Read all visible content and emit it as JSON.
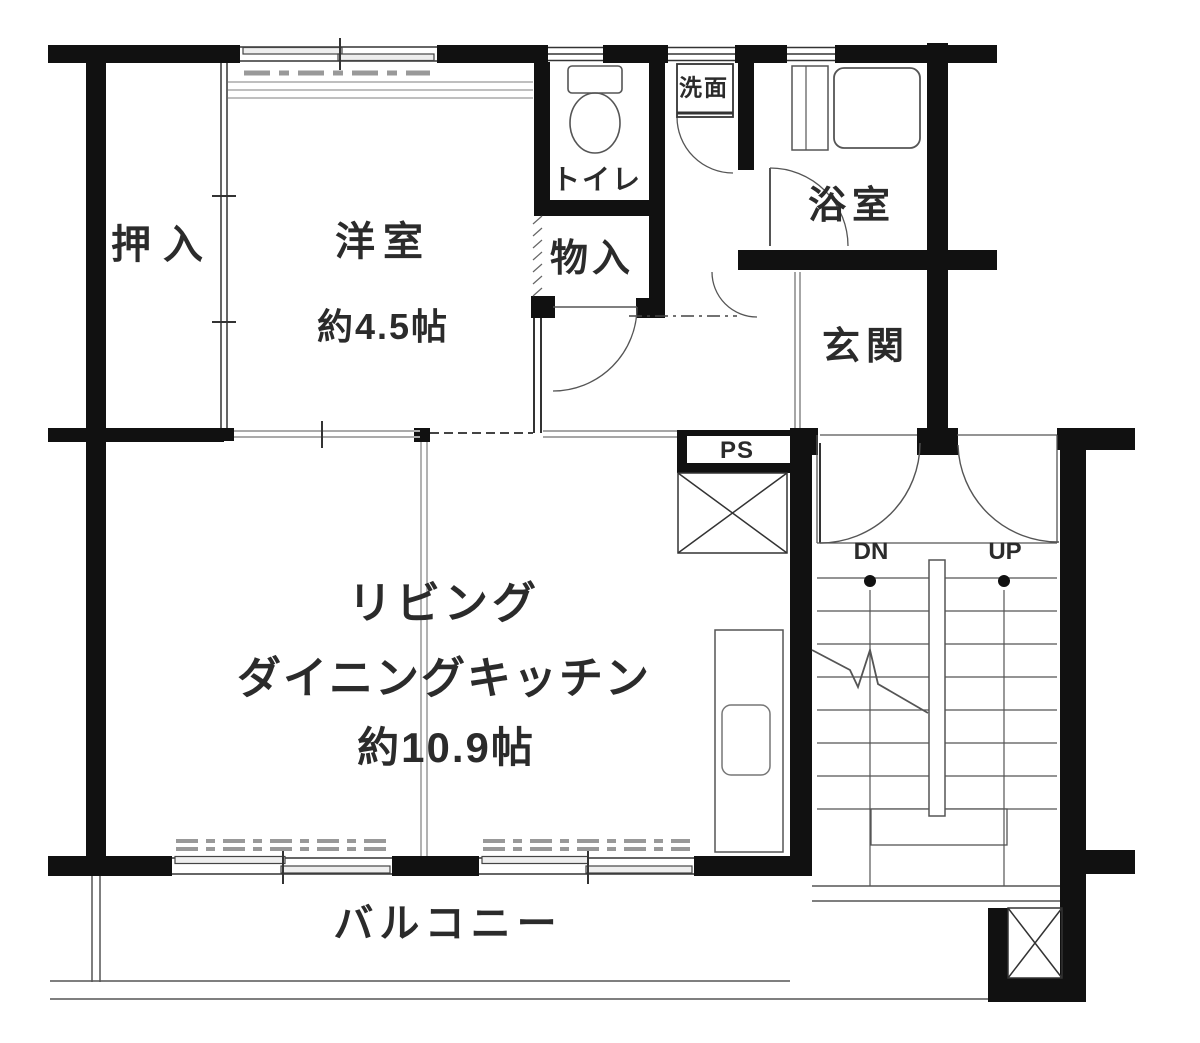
{
  "plan": {
    "rooms": {
      "closet": "押入",
      "western_room": "洋室",
      "western_room_size": "約4.5帖",
      "toilet": "トイレ",
      "washstand": "洗面",
      "storage": "物入",
      "bathroom": "浴室",
      "entrance": "玄関",
      "living_line1": "リビング",
      "living_line2": "ダイニングキッチン",
      "living_size": "約10.9帖",
      "balcony": "バルコニー",
      "pipe_shaft": "PS",
      "stairs_down": "DN",
      "stairs_up": "UP"
    },
    "colors": {
      "wall": "#111111",
      "line": "#555555",
      "text": "#2b2b2b",
      "background": "#ffffff"
    }
  }
}
